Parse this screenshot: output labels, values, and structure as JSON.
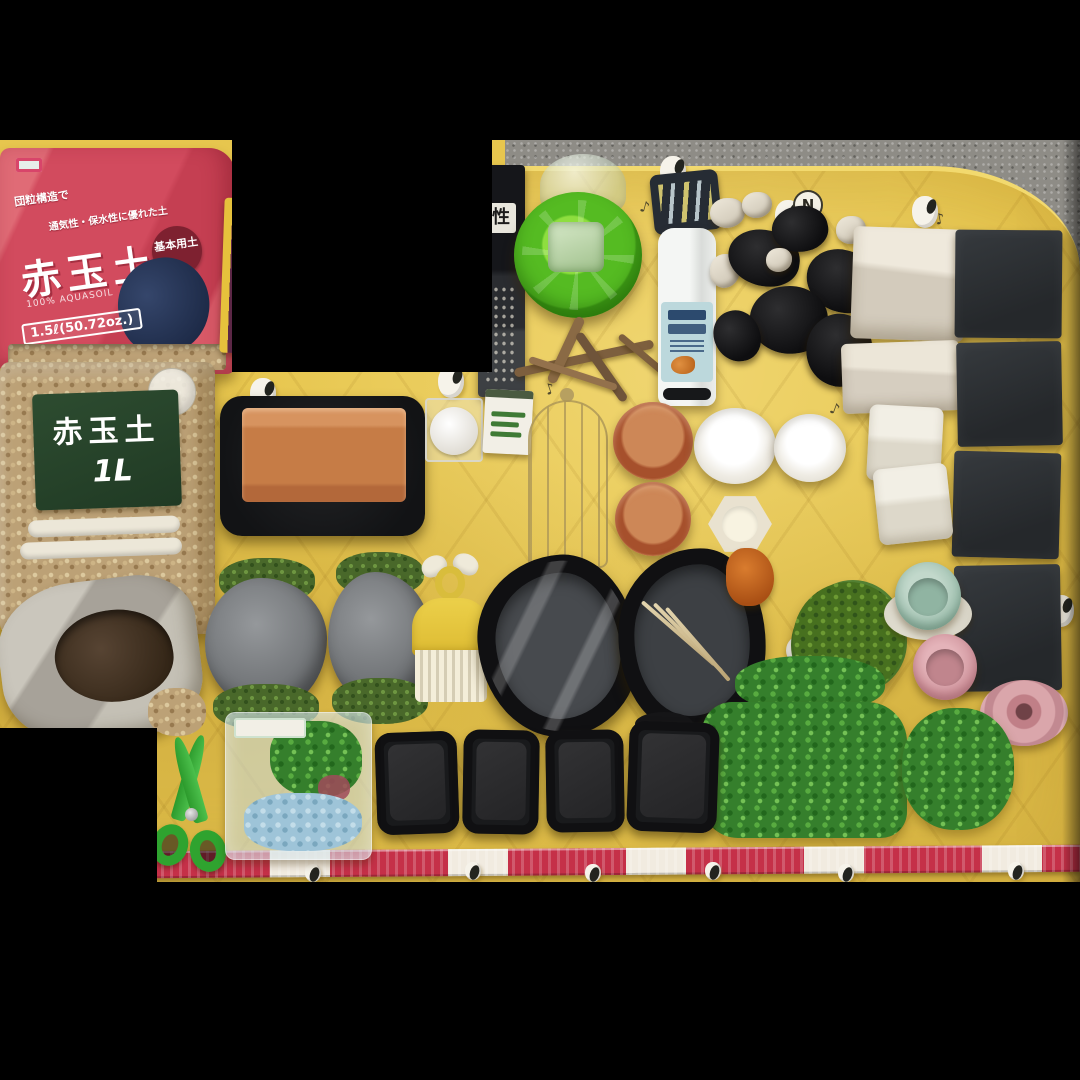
{
  "scene": {
    "description": "Flat-lay photo of terrarium and reptile-keeping supplies arranged on a yellow quilted Snoopy blanket, letterboxed on black",
    "background": "#000000"
  },
  "colors": {
    "blanket_yellow": "#e7c64e",
    "floor_gray": "#8e8c86",
    "bag_red": "#d24b5e",
    "label_green": "#27422a",
    "feeder_green": "#55bb22",
    "terracotta": "#c67c46",
    "slate_dark": "#2f3235",
    "dish_black": "#191a1c",
    "plant_green": "#357f2c",
    "scissors_green": "#2fa32f",
    "tape_red": "#c53048",
    "pot_pink": "#d298a0",
    "cup_blue": "#a5c4b4"
  },
  "red_bag": {
    "diag1": "団粒構造で",
    "diag2": "通気性・保水性に優れた土",
    "title": "赤玉土",
    "subtitle": "100% AQUASOIL",
    "size": "1.5ℓ(50.72oz.)",
    "badge": "基本用土"
  },
  "green_bag": {
    "title": "赤玉土",
    "size": "1L"
  },
  "dark_package": {
    "char": "性"
  },
  "blanket_motif": {
    "circle_char": "N",
    "note": "♪"
  },
  "objects": [
    "akadama-soil-bag-red-1.5L",
    "akadama-soil-bag-green-1L",
    "open-soil-bag",
    "purple-chopsticks",
    "dark-product-package",
    "green-gravity-water-feeder",
    "driftwood-branch",
    "spray-bottle-with-tag",
    "charcoal-pieces-and-white-stones",
    "white-square-tray",
    "white-rectangular-tray",
    "slate-tiles-x4",
    "terracotta-tile-on-black-tray",
    "round-white-tub-in-clear-box",
    "seed-packet",
    "gold-wire-cage-ornament",
    "terracotta-saucers-x2",
    "white-round-dishes-x2",
    "cream-hexagon-dish",
    "small-white-caps-x4",
    "white-square-dishes-x2",
    "moss-covered-rocks-x2",
    "yellow-mini-comb-scoop",
    "black-rock-water-dish-wrapped",
    "black-rock-water-dish-with-bamboo-tweezers",
    "orange-ornament",
    "artificial-moss-ball",
    "blue-cup",
    "pink-cup",
    "pink-saucer",
    "artificial-plant-mat-large",
    "artificial-plant-round",
    "black-feeding-dishes-x4",
    "green-scissors",
    "bagged-artificial-aquarium-plant",
    "red-white-measuring-tape"
  ]
}
